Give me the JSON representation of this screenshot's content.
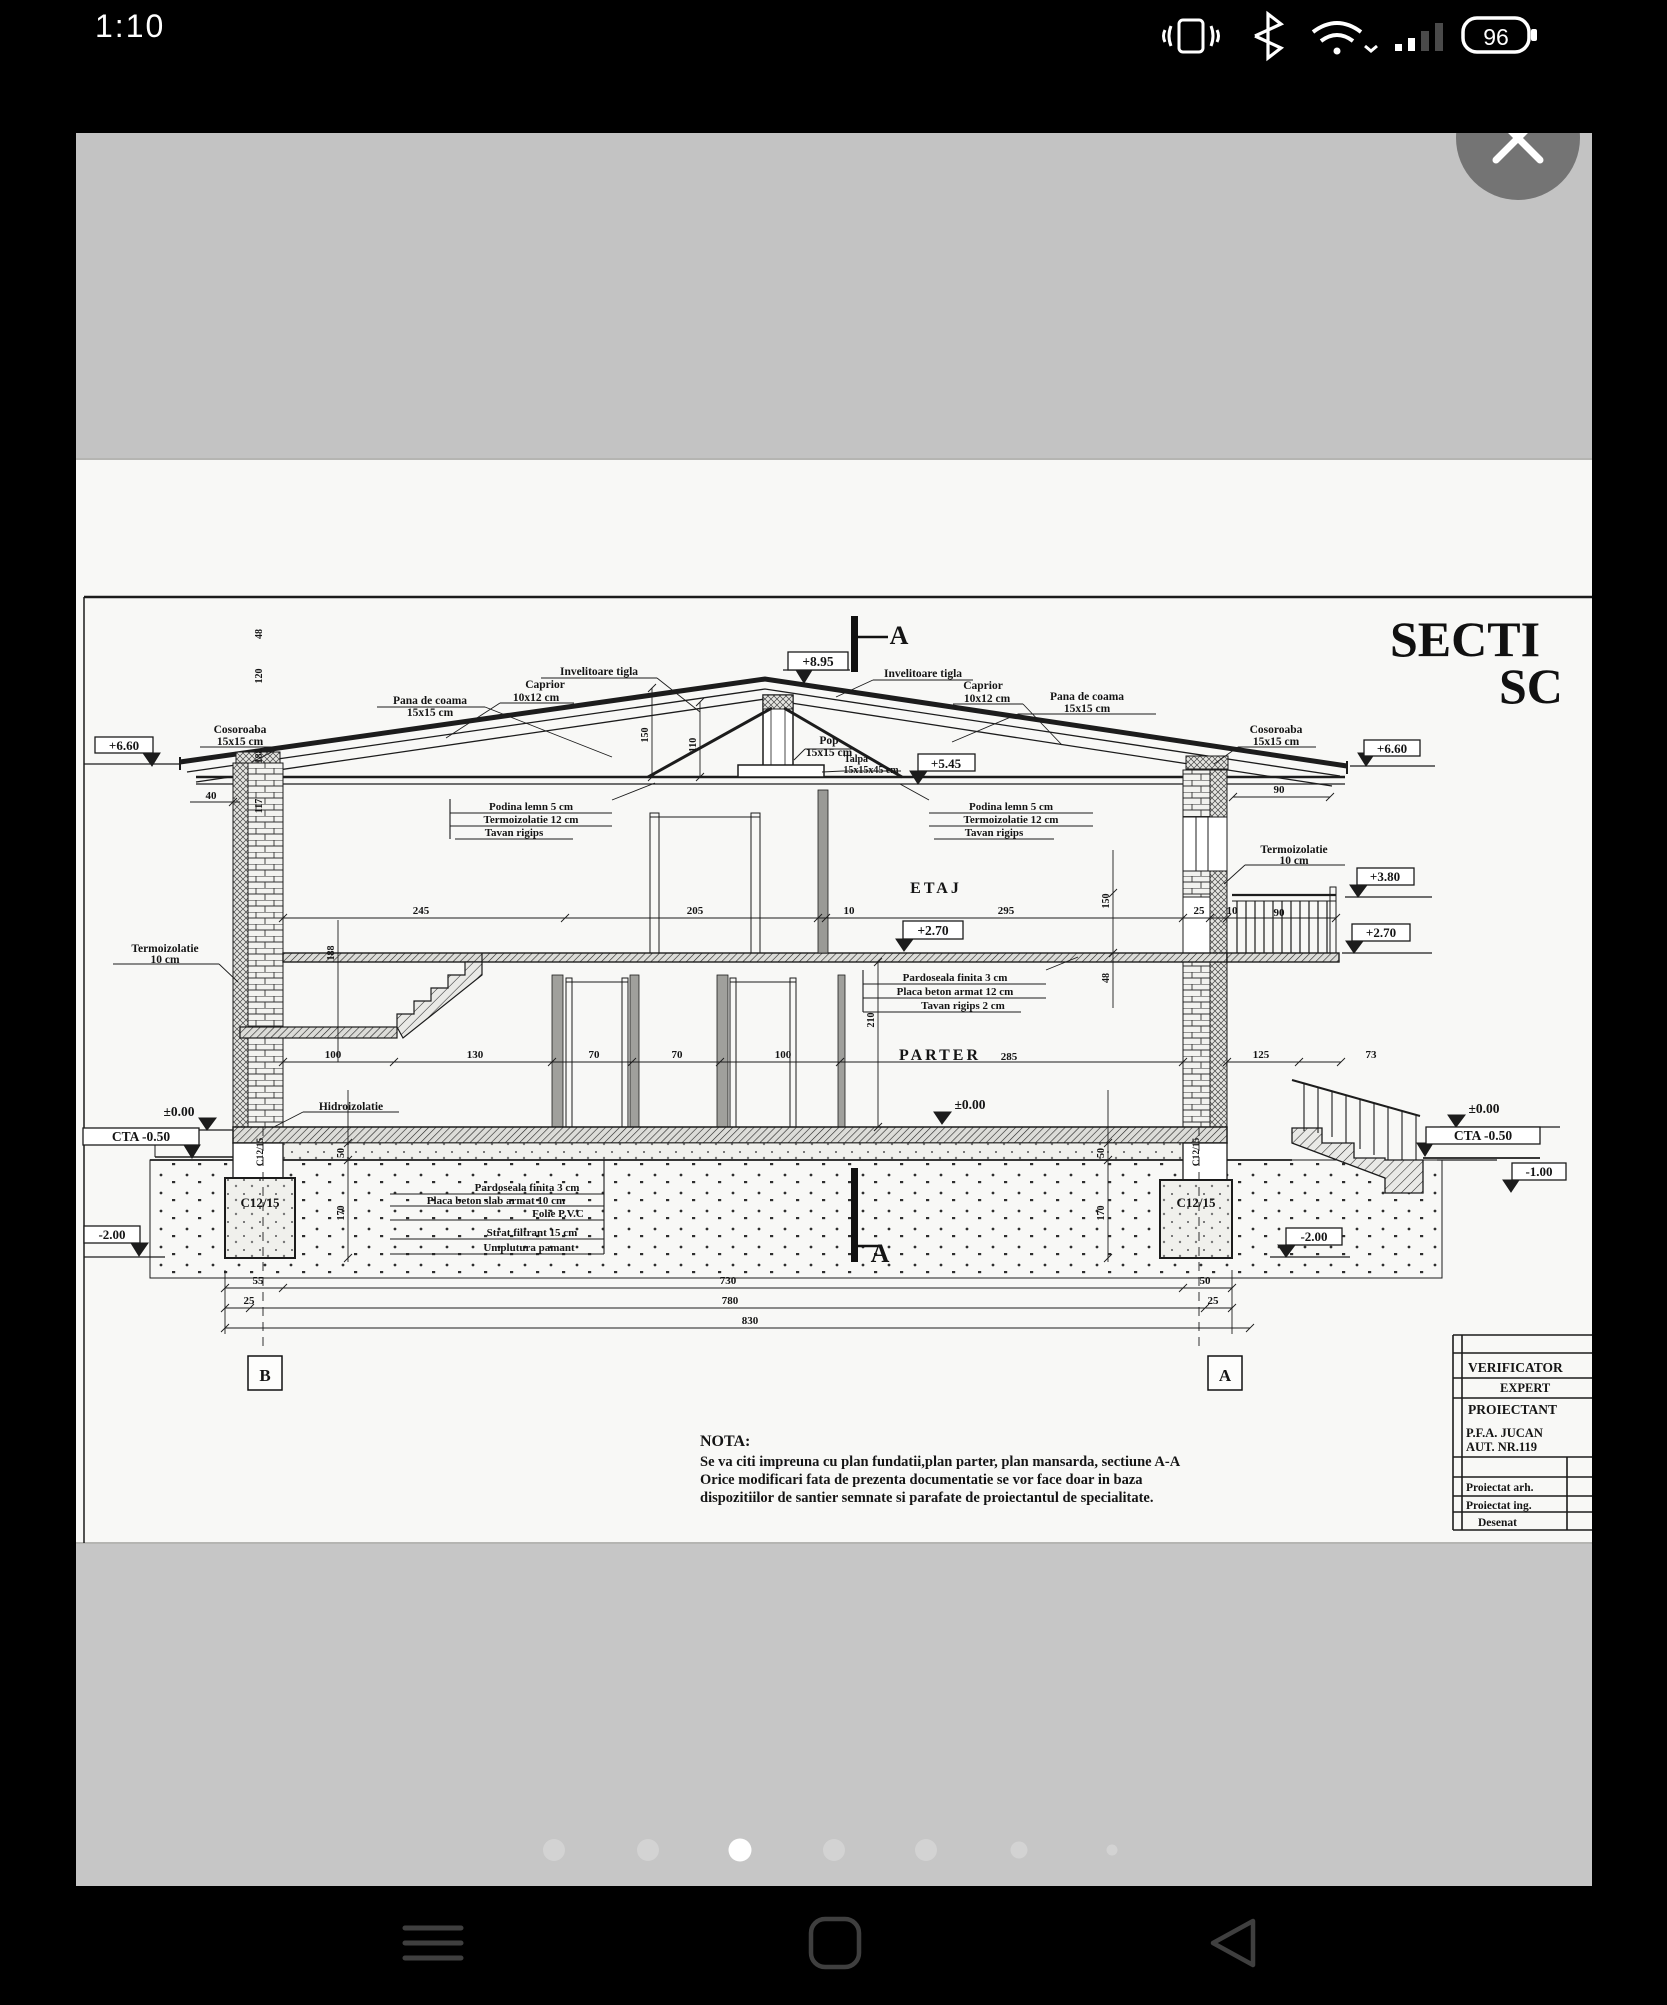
{
  "status_bar": {
    "time": "1:10",
    "battery_percent": "96"
  },
  "viewer": {
    "total_dots": 7,
    "active_dot": 3
  },
  "drawing": {
    "title1": "SECTI",
    "title2": "SC",
    "roof": {
      "inv": "Invelitoare tigla",
      "caprior": "Caprior",
      "caprior_dim": "10x12 cm",
      "pana": "Pana de coama",
      "pana_dim": "15x15 cm",
      "cos": "Cosoroaba",
      "cos_dim": "15x15 cm",
      "pop": "Pop",
      "pop_dim": "15x15 cm",
      "talpa": "Talpa",
      "talpa_dim": "15x15x45 cm"
    },
    "levels": {
      "l895": "+8.95",
      "l660": "+6.60",
      "l545": "+5.45",
      "l380": "+3.80",
      "l270": "+2.70",
      "l0": "±0.00",
      "cta": "CTA  -0.50",
      "lm1": "-1.00",
      "lm2": "-2.00"
    },
    "rooms": {
      "etaj": "ETAJ",
      "parter": "PARTER"
    },
    "marks": {
      "sec": "A",
      "axis_b": "B",
      "axis_a": "A"
    },
    "boxes": {
      "podina1": "Podina lemn 5 cm",
      "podina2": "Termoizolatie 12 cm",
      "podina3": "Tavan rigips",
      "floor1": "Pardoseala finita 3 cm",
      "floor2": "Placa beton armat 12 cm",
      "floor3": "Tavan rigips 2 cm",
      "ground1": "Pardoseala finita 3 cm",
      "ground2": "Placa beton slab armat 10 cm",
      "ground3": "Folie P.V.C",
      "ground4": "Strat filtrant 15 cm",
      "ground5": "Umplutura pamant"
    },
    "materials": {
      "termo": "Termoizolatie",
      "termo_dim": "10 cm",
      "hidro": "Hidroizolatie",
      "beton": "C12/15"
    },
    "dims": {
      "d245": "245",
      "d205": "205",
      "d10": "10",
      "d295": "295",
      "d100": "100",
      "d130": "130",
      "d70": "70",
      "d285": "285",
      "d125": "125",
      "d73": "73",
      "d90": "90",
      "d40": "40",
      "d25": "25",
      "d150": "150",
      "d110": "110",
      "d188": "188",
      "d210": "210",
      "d48": "48",
      "d120": "120",
      "d117": "117",
      "d50": "50",
      "d170": "170",
      "d55": "55",
      "d730": "730",
      "d780": "780",
      "d830": "830"
    },
    "note": {
      "heading": "NOTA:",
      "l1": "Se va citi impreuna cu plan fundatii,plan parter, plan mansarda, sectiune A-A",
      "l2": "Orice modificari fata de prezenta documentatie se vor face doar in baza",
      "l3": "dispozitiilor de santier semnate si parafate de proiectantul de specialitate."
    },
    "title_block": {
      "r1": "VERIFICATOR",
      "r2": "EXPERT",
      "r3": "PROIECTANT",
      "firm1": "P.F.A. JUCAN",
      "firm2": "AUT. NR.119",
      "role1": "Proiectat arh.",
      "role2": "Proiectat ing.",
      "role3": "Desenat"
    }
  }
}
